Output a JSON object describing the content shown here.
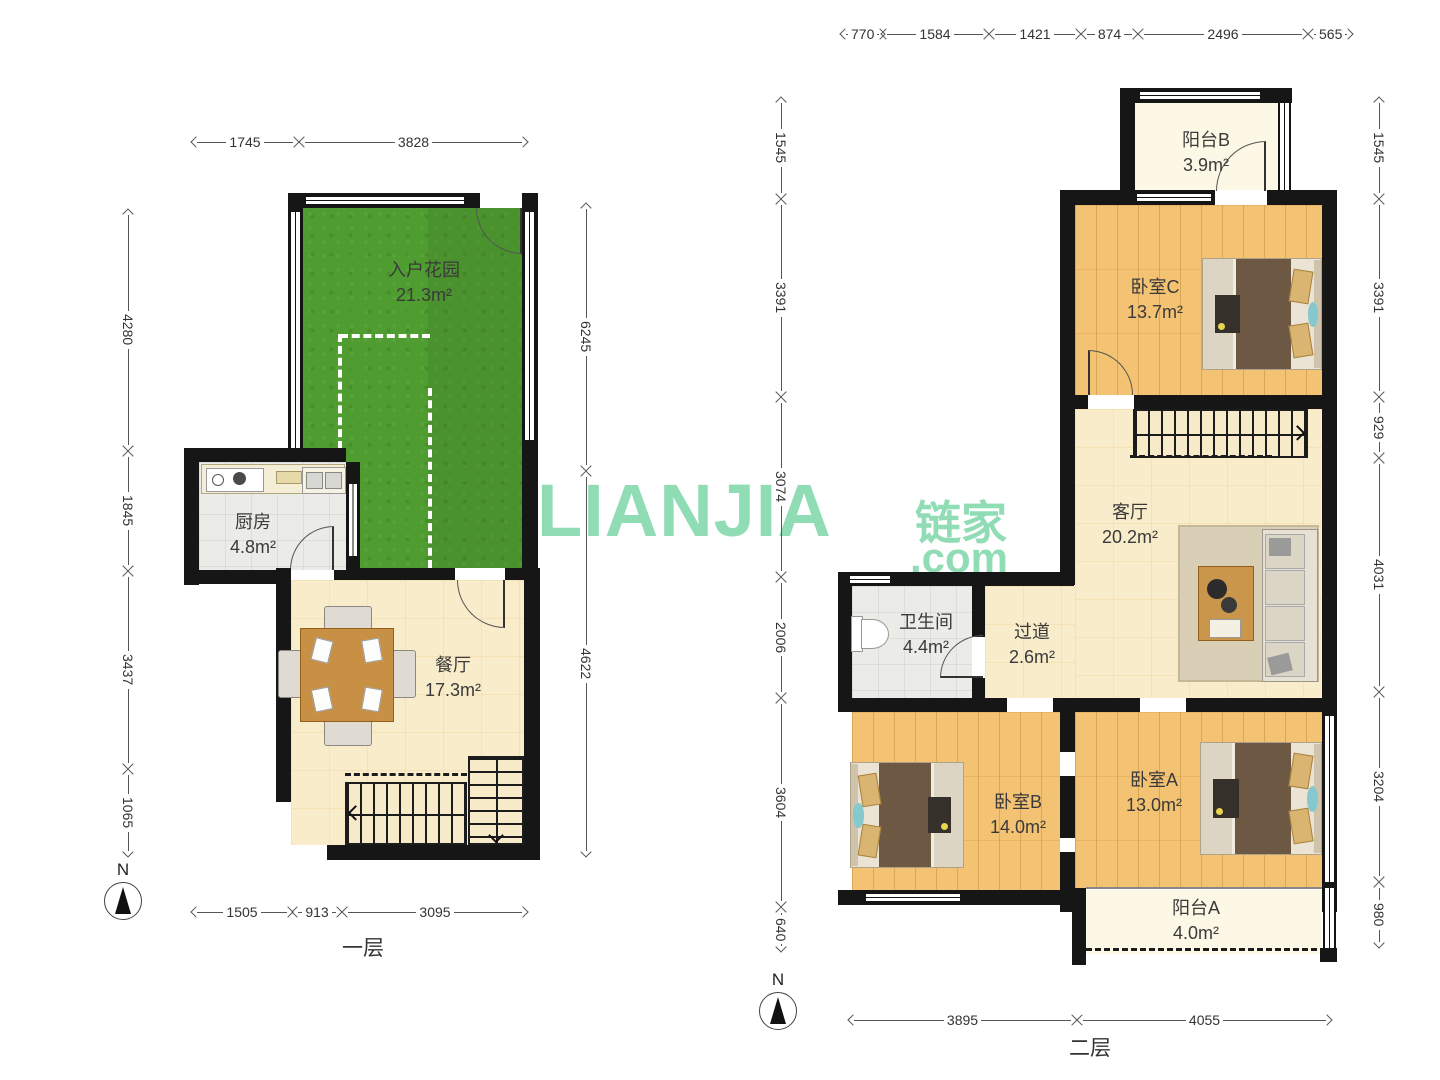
{
  "watermark": {
    "latin": "LIANJIA",
    "cn": "链家",
    "com": ".com",
    "color": "#8fdcb5"
  },
  "compass": {
    "north": "N"
  },
  "f1": {
    "title": "一层",
    "rooms": {
      "garden": {
        "name": "入户花园",
        "area": "21.3m²"
      },
      "kitchen": {
        "name": "厨房",
        "area": "4.8m²"
      },
      "dining": {
        "name": "餐厅",
        "area": "17.3m²"
      }
    },
    "dims": {
      "top": [
        "1745",
        "3828"
      ],
      "left": [
        "4280",
        "1845",
        "3437",
        "1065"
      ],
      "right": [
        "6245",
        "4622"
      ],
      "bottom": [
        "1505",
        "913",
        "3095"
      ]
    }
  },
  "f2": {
    "title": "二层",
    "rooms": {
      "balcony_b": {
        "name": "阳台B",
        "area": "3.9m²"
      },
      "bedroom_c": {
        "name": "卧室C",
        "area": "13.7m²"
      },
      "living": {
        "name": "客厅",
        "area": "20.2m²"
      },
      "bathroom": {
        "name": "卫生间",
        "area": "4.4m²"
      },
      "hallway": {
        "name": "过道",
        "area": "2.6m²"
      },
      "bedroom_b": {
        "name": "卧室B",
        "area": "14.0m²"
      },
      "bedroom_a": {
        "name": "卧室A",
        "area": "13.0m²"
      },
      "balcony_a": {
        "name": "阳台A",
        "area": "4.0m²"
      }
    },
    "dims": {
      "top": [
        "770",
        "1584",
        "1421",
        "874",
        "2496",
        "565"
      ],
      "left": [
        "1545",
        "3391",
        "3074",
        "2006",
        "3604",
        "640"
      ],
      "right": [
        "1545",
        "3391",
        "929",
        "4031",
        "3204",
        "980"
      ],
      "bottom": [
        "3895",
        "4055"
      ]
    }
  }
}
